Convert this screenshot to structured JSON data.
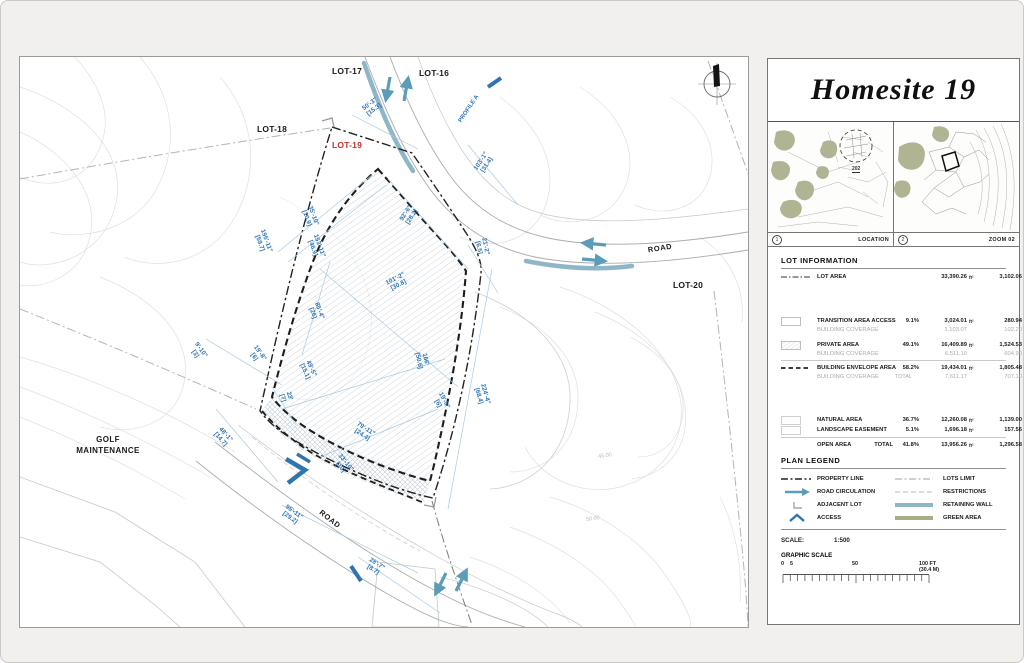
{
  "title": "Homesite 19",
  "units": {
    "ft2": "ft²",
    "m2": "m²"
  },
  "colors": {
    "dimension_blue": "#2e74b5",
    "circulation_blue": "#5b9db8",
    "retaining_wall": "#8fb6c6",
    "green_area": "#a9ac87",
    "lot19_red": "#c43027"
  },
  "plan": {
    "lots": {
      "lot17": "LOT-17",
      "lot16": "LOT-16",
      "lot18": "LOT-18",
      "lot19": "LOT-19",
      "lot20": "LOT-20"
    },
    "road_label": "ROAD",
    "golf_line1": "GOLF",
    "golf_line2": "MAINTENANCE",
    "profile_a": "PROFILE A",
    "contours": {
      "c45": "45.00",
      "c50": "50.00"
    },
    "dimensions": [
      {
        "ft": "50'-3\"",
        "m": "[15.3]"
      },
      {
        "ft": "103'-1\"",
        "m": "[31.4]"
      },
      {
        "ft": "195'-11\"",
        "m": "[59.7]"
      },
      {
        "ft": "35'-10\"",
        "m": "[10.9]"
      },
      {
        "ft": "153'-11\"",
        "m": "[46.9]"
      },
      {
        "ft": "92'-6\"",
        "m": "[28.2]"
      },
      {
        "ft": "101'-2\"",
        "m": "[30.8]"
      },
      {
        "ft": "21'-2\"",
        "m": "[6.5]"
      },
      {
        "ft": "85'-4\"",
        "m": "[26]"
      },
      {
        "ft": "9'-10\"",
        "m": "[3]"
      },
      {
        "ft": "19'-8\"",
        "m": "[6]"
      },
      {
        "ft": "23'",
        "m": "[7]"
      },
      {
        "ft": "49'-5\"",
        "m": "[15.1]"
      },
      {
        "ft": "166'",
        "m": "[50.6]"
      },
      {
        "ft": "19'-8\"",
        "m": "[6]"
      },
      {
        "ft": "224'-4\"",
        "m": "[68.4]"
      },
      {
        "ft": "79'-11\"",
        "m": "[24.4]"
      },
      {
        "ft": "33'-10\"",
        "m": "[10]"
      },
      {
        "ft": "48'-1\"",
        "m": "[14.7]"
      },
      {
        "ft": "95'-11\"",
        "m": "[29.2]"
      },
      {
        "ft": "28'-7\"",
        "m": "[8.7]"
      }
    ]
  },
  "panel": {
    "maps": {
      "left_num": "1",
      "left_label": "LOCATION",
      "right_num": "2",
      "right_label": "ZOOM 02",
      "callout": "202"
    },
    "lot_information": {
      "header": "LOT INFORMATION",
      "lot_area": {
        "label": "LOT AREA",
        "ft2": "33,390.26",
        "m2": "3,102.06"
      },
      "groups": [
        {
          "label": "TRANSITION AREA ACCESS",
          "pct": "9.1%",
          "ft2": "3,024.01",
          "m2": "280.94",
          "sub": {
            "label": "BUILDING COVERAGE",
            "total": "",
            "ft2": "1,103.07",
            "m2": "102.20"
          }
        },
        {
          "label": "PRIVATE AREA",
          "pct": "49.1%",
          "ft2": "16,409.89",
          "m2": "1,524.53",
          "sub": {
            "label": "BUILDING COVERAGE",
            "total": "",
            "ft2": "6,511.10",
            "m2": "604.90"
          }
        },
        {
          "label": "BUILDING ENVELOPE AREA",
          "pct": "58.2%",
          "ft2": "19,434.01",
          "m2": "1,805.48",
          "sub": {
            "label": "BUILDING COVERAGE",
            "total": "TOTAL",
            "ft2": "7,611.17",
            "m2": "707.10"
          }
        }
      ],
      "open": [
        {
          "label": "NATURAL AREA",
          "pct": "36.7%",
          "ft2": "12,260.08",
          "m2": "1,139.00"
        },
        {
          "label": "LANDSCAPE EASEMENT",
          "pct": "5.1%",
          "ft2": "1,696.18",
          "m2": "157.56"
        }
      ],
      "open_total": {
        "label": "OPEN AREA",
        "total": "TOTAL",
        "pct": "41.8%",
        "ft2": "13,956.26",
        "m2": "1,296.58"
      }
    },
    "plan_legend": {
      "header": "PLAN LEGEND",
      "left": [
        {
          "label": "PROPERTY LINE"
        },
        {
          "label": "ROAD CIRCULATION"
        },
        {
          "label": "ADJACENT LOT"
        },
        {
          "label": "ACCESS"
        }
      ],
      "right": [
        {
          "label": "LOTS LIMIT"
        },
        {
          "label": "RESTRICTIONS"
        },
        {
          "label": "RETAINING WALL"
        },
        {
          "label": "GREEN AREA"
        }
      ]
    },
    "scale": {
      "label": "SCALE:",
      "value": "1:500",
      "graphic_label": "GRAPHIC SCALE",
      "tick_0": "0",
      "tick_5": "5",
      "tick_50": "50",
      "tick_100": "100 FT",
      "metric": "(30.4 M)"
    }
  }
}
